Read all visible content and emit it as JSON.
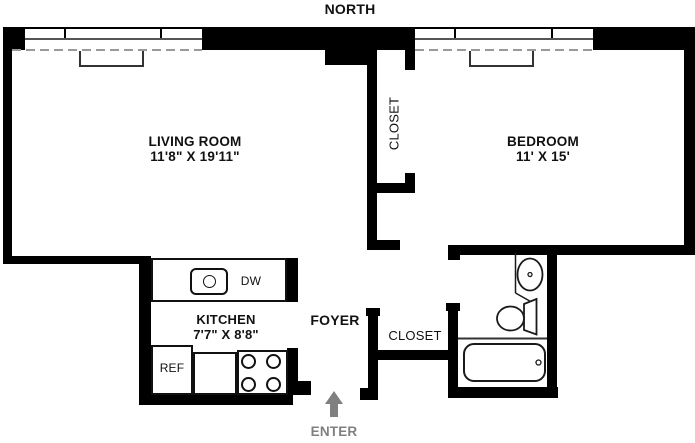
{
  "compass": {
    "label": "NORTH"
  },
  "rooms": {
    "living_room": {
      "name": "LIVING ROOM",
      "dimensions": "11'8\" X 19'11\""
    },
    "bedroom": {
      "name": "BEDROOM",
      "dimensions": "11' X 15'"
    },
    "kitchen": {
      "name": "KITCHEN",
      "dimensions": "7'7\" X 8'8\""
    },
    "foyer": {
      "name": "FOYER"
    },
    "closet_bedroom": {
      "name": "CLOSET"
    },
    "closet_foyer": {
      "name": "CLOSET"
    }
  },
  "appliances": {
    "dishwasher": "DW",
    "refrigerator": "REF"
  },
  "fixtures": [
    "kitchen-sink",
    "stove-burners",
    "bathroom-sink",
    "toilet",
    "bathtub",
    "radiator",
    "radiator"
  ],
  "entry": {
    "label": "ENTER"
  },
  "colors": {
    "wall": "#000000",
    "fixture_line": "#1a1a1a",
    "dashed_line": "#999999",
    "entry_gray": "#808080",
    "background": "#ffffff"
  }
}
